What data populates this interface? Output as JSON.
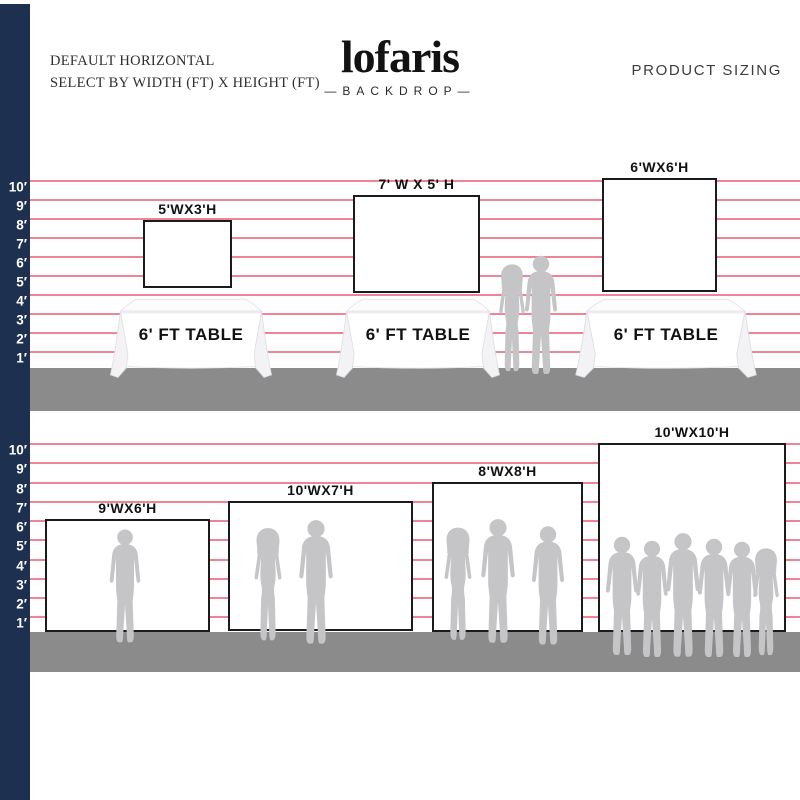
{
  "header": {
    "left_line1": "DEFAULT HORIZONTAL",
    "left_line2": "SELECT BY WIDTH (FT) X HEIGHT (FT)",
    "product_sizing": "PRODUCT SIZING"
  },
  "brand": {
    "name": "lofaris",
    "tagline": "—BACKDROP—"
  },
  "ruler": {
    "labels": [
      "10′",
      "9′",
      "8′",
      "7′",
      "6′",
      "5′",
      "4′",
      "3′",
      "2′",
      "1′"
    ]
  },
  "top_section": {
    "table_label": "6' FT TABLE",
    "backdrops": [
      {
        "label": "5'WX3'H"
      },
      {
        "label": "7' W X 5' H"
      },
      {
        "label": "6'WX6'H"
      }
    ]
  },
  "bottom_section": {
    "backdrops": [
      {
        "label": "9'WX6'H"
      },
      {
        "label": "10'WX7'H"
      },
      {
        "label": "8'WX8'H"
      },
      {
        "label": "10'WX10'H"
      }
    ]
  },
  "colors": {
    "navy": "#1d3050",
    "pink_line": "#ee8496",
    "floor_gray": "#8b8b8b",
    "silhouette_gray": "#c5c5c8",
    "rect_border": "#1b1b1b"
  }
}
